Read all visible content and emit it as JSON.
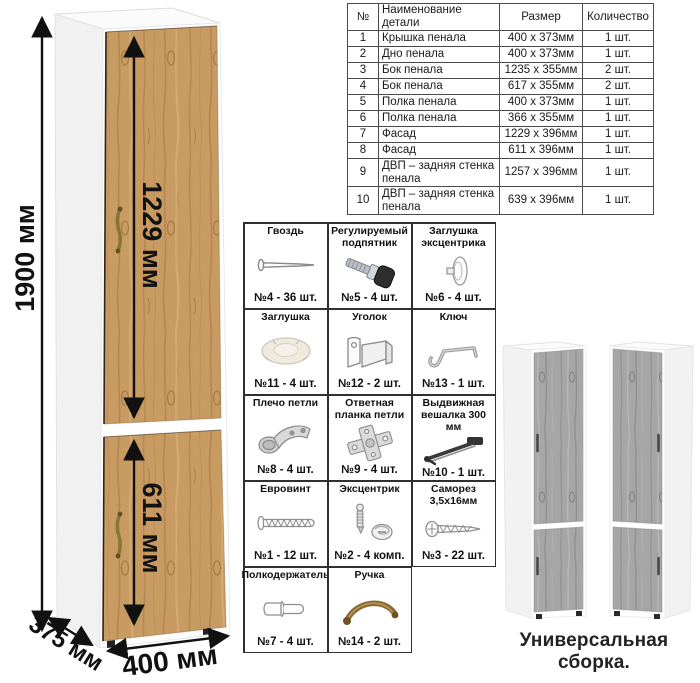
{
  "main_cabinet": {
    "dim_height": "1900 мм",
    "dim_upper_door": "1229 мм",
    "dim_lower_door": "611 мм",
    "dim_width": "400 мм",
    "dim_depth": "375 мм"
  },
  "parts_table": {
    "headers": [
      "№",
      "Наименование детали",
      "Размер",
      "Количество"
    ],
    "rows": [
      {
        "num": "1",
        "name": "Крышка пенала",
        "size": "400 х 373мм",
        "qty": "1 шт."
      },
      {
        "num": "2",
        "name": "Дно пенала",
        "size": "400 х 373мм",
        "qty": "1 шт."
      },
      {
        "num": "3",
        "name": "Бок пенала",
        "size": "1235 х 355мм",
        "qty": "2 шт."
      },
      {
        "num": "4",
        "name": "Бок пенала",
        "size": "617 х 355мм",
        "qty": "2 шт."
      },
      {
        "num": "5",
        "name": "Полка пенала",
        "size": "400 х 373мм",
        "qty": "1 шт."
      },
      {
        "num": "6",
        "name": "Полка пенала",
        "size": "366 х 355мм",
        "qty": "1 шт."
      },
      {
        "num": "7",
        "name": "Фасад",
        "size": "1229 х 396мм",
        "qty": "1 шт."
      },
      {
        "num": "8",
        "name": "Фасад",
        "size": "611 х 396мм",
        "qty": "1 шт."
      },
      {
        "num": "9",
        "name": "ДВП – задняя стенка пенала",
        "size": "1257 х 396мм",
        "qty": "1 шт."
      },
      {
        "num": "10",
        "name": "ДВП – задняя стенка пенала",
        "size": "639 х 396мм",
        "qty": "1 шт."
      }
    ]
  },
  "hardware": {
    "items": [
      {
        "title": "Гвоздь",
        "count": "№4 - 36 шт.",
        "icon": "nail-icon"
      },
      {
        "title": "Регулируемый подпятник",
        "count": "№5 - 4 шт.",
        "icon": "adjustable-foot-icon"
      },
      {
        "title": "Заглушка эксцентрика",
        "count": "№6 - 4 шт.",
        "icon": "cam-cover-icon"
      },
      {
        "title": "Заглушка",
        "count": "№11 - 4 шт.",
        "icon": "cap-icon"
      },
      {
        "title": "Уголок",
        "count": "№12 - 2 шт.",
        "icon": "corner-bracket-icon"
      },
      {
        "title": "Ключ",
        "count": "№13 - 1 шт.",
        "icon": "hex-key-icon"
      },
      {
        "title": "Плечо петли",
        "count": "№8 - 4 шт.",
        "icon": "hinge-arm-icon"
      },
      {
        "title": "Ответная планка петли",
        "count": "№9 - 4 шт.",
        "icon": "hinge-plate-icon"
      },
      {
        "title": "Выдвижная вешалка 300 мм",
        "count": "№10 - 1 шт.",
        "icon": "pullout-rail-icon"
      },
      {
        "title": "Евровинт",
        "count": "№1 - 12 шт.",
        "icon": "euro-screw-icon"
      },
      {
        "title": "Эксцентрик",
        "count": "№2 - 4 комп.",
        "icon": "cam-lock-icon"
      },
      {
        "title": "Саморез 3,5х16мм",
        "count": "№3 - 22 шт.",
        "icon": "self-tapping-screw-icon"
      },
      {
        "title": "Полкодержатель",
        "count": "№7 - 4 шт.",
        "icon": "shelf-pin-icon"
      },
      {
        "title": "Ручка",
        "count": "№14 - 2 шт.",
        "icon": "handle-icon"
      }
    ]
  },
  "footer": {
    "caption": "Универсальная сборка."
  },
  "colors": {
    "wood": "#c89b63",
    "wood_dark": "#a87f4b",
    "gray_wood": "#a6a6a6",
    "gray_wood_dark": "#8e8e8e",
    "handle_bronze": "#8a6a33",
    "arrow": "#111111",
    "carcass_white": "#ffffff"
  }
}
